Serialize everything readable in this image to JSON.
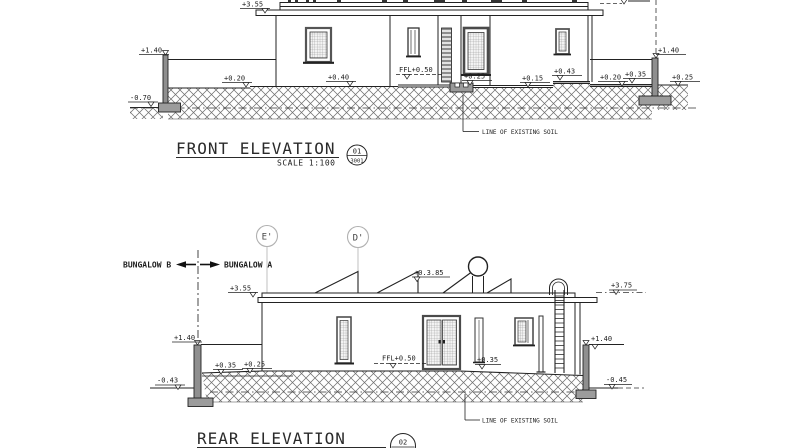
{
  "front": {
    "title": "FRONT ELEVATION",
    "scale": "SCALE 1:100",
    "tag": {
      "number": "01",
      "sheet": "3001"
    },
    "levels": {
      "roof": "+3.55",
      "left_wall": "+1.40",
      "left_ground": "-0.70",
      "terrace_020": "+0.20",
      "terrace_040": "+0.40",
      "ffl": "FFL+0.50",
      "step_025": "+0.25",
      "terrace_015": "+0.15",
      "terrace_043": "+0.43",
      "terrace_020b": "+0.20",
      "terrace_035": "+0.35",
      "right_wall": "+1.40",
      "right_ground": "+0.25"
    },
    "notes": {
      "soil": "LINE OF EXISTING SOIL"
    }
  },
  "rear": {
    "title": "REAR ELEVATION",
    "tag": {
      "number": "02"
    },
    "grids": {
      "e": "E'",
      "d": "D'"
    },
    "bungalow_b": "BUNGALOW B",
    "bungalow_a": "BUNGALOW A",
    "levels": {
      "roof": "+3.55",
      "solar": "+0.3.85",
      "roof_right": "+3.75",
      "left_wall": "+1.40",
      "left_ground": "-0.43",
      "terrace_035": "+0.35",
      "terrace_025": "+0.25",
      "ffl": "FFL+0.50",
      "door_035": "+0.35",
      "right_wall": "+1.40",
      "right_ground": "-0.45"
    },
    "notes": {
      "soil": "LINE OF EXISTING SOIL"
    }
  }
}
